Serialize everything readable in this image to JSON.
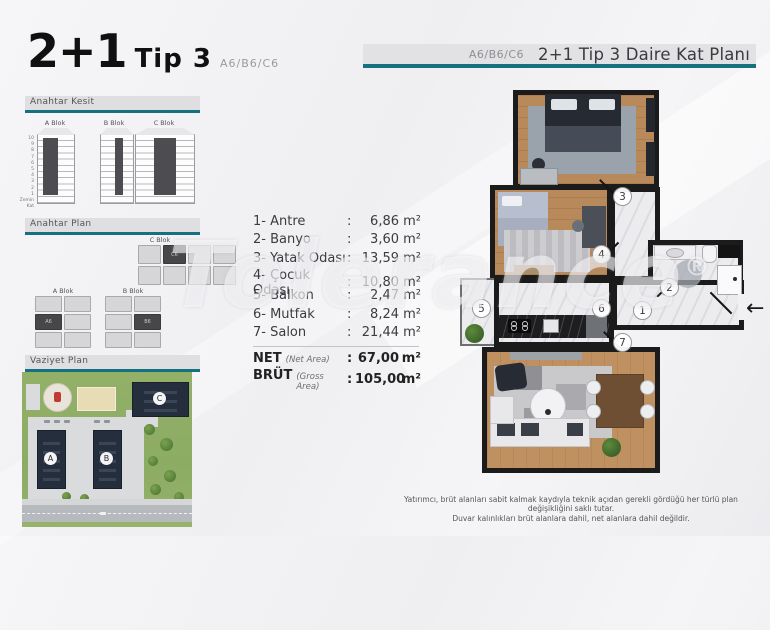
{
  "colors": {
    "teal": "#15717f",
    "wall": "#1b1b1b",
    "building_navy": "#242e3d",
    "bar_gray": "#e2e2e5"
  },
  "watermark": {
    "text": "Tolerance",
    "reg": "®"
  },
  "title_block": {
    "main": "2+1",
    "sub": "Tip 3",
    "units": "A6/B6/C6"
  },
  "right_header": {
    "units": "A6/B6/C6",
    "title": "2+1 Tip 3 Daire Kat Planı"
  },
  "sections": {
    "kesit": "Anahtar Kesit",
    "plan": "Anahtar Plan",
    "vaziyet": "Vaziyet Plan"
  },
  "kesit": {
    "blocks": [
      {
        "label": "A Blok"
      },
      {
        "label": "B Blok"
      },
      {
        "label": "C Blok"
      }
    ],
    "floors": [
      "10",
      "9",
      "8",
      "7",
      "6",
      "5",
      "4",
      "3",
      "2",
      "1"
    ],
    "ground": "Zemin Kat"
  },
  "anahtar_plan": {
    "a_label": "A Blok",
    "b_label": "B Blok",
    "c_label": "C Blok",
    "a_unit": "A6",
    "b_unit": "B6",
    "c_unit": "C6"
  },
  "rooms": [
    {
      "label": "1- Antre",
      "sep": ":",
      "value": "6,86",
      "unit": "m²"
    },
    {
      "label": "2- Banyo",
      "sep": ":",
      "value": "3,60",
      "unit": "m²"
    },
    {
      "label": "3- Yatak Odası",
      "sep": ":",
      "value": "13,59",
      "unit": "m²"
    },
    {
      "label": "4- Çocuk Odası",
      "sep": ":",
      "value": "10,80",
      "unit": "m²"
    },
    {
      "label": "5- Balkon",
      "sep": ":",
      "value": "2,47",
      "unit": "m²"
    },
    {
      "label": "6- Mutfak",
      "sep": ":",
      "value": "8,24",
      "unit": "m²"
    },
    {
      "label": "7- Salon",
      "sep": ":",
      "value": "21,44",
      "unit": "m²"
    }
  ],
  "areas": {
    "net_label": "NET",
    "net_note": "(Net Area)",
    "net_sep": ":",
    "net_value": "67,00",
    "net_unit": "m²",
    "brut_label": "BRÜT",
    "brut_note": "(Gross Area)",
    "brut_sep": ":",
    "brut_value": "105,00",
    "brut_unit": "m²"
  },
  "site": {
    "a": "A",
    "b": "B",
    "c": "C"
  },
  "plan": {
    "markers": [
      "1",
      "2",
      "3",
      "4",
      "5",
      "6",
      "7"
    ],
    "entry_arrow": "←"
  },
  "disclaimer": {
    "line1": "Yatırımcı, brüt alanları sabit kalmak kaydıyla teknik açıdan gerekli gördüğü her türlü plan değişikliğini saklı tutar.",
    "line2": "Duvar kalınlıkları brüt alanlara dahil, net alanlara dahil değildir."
  }
}
